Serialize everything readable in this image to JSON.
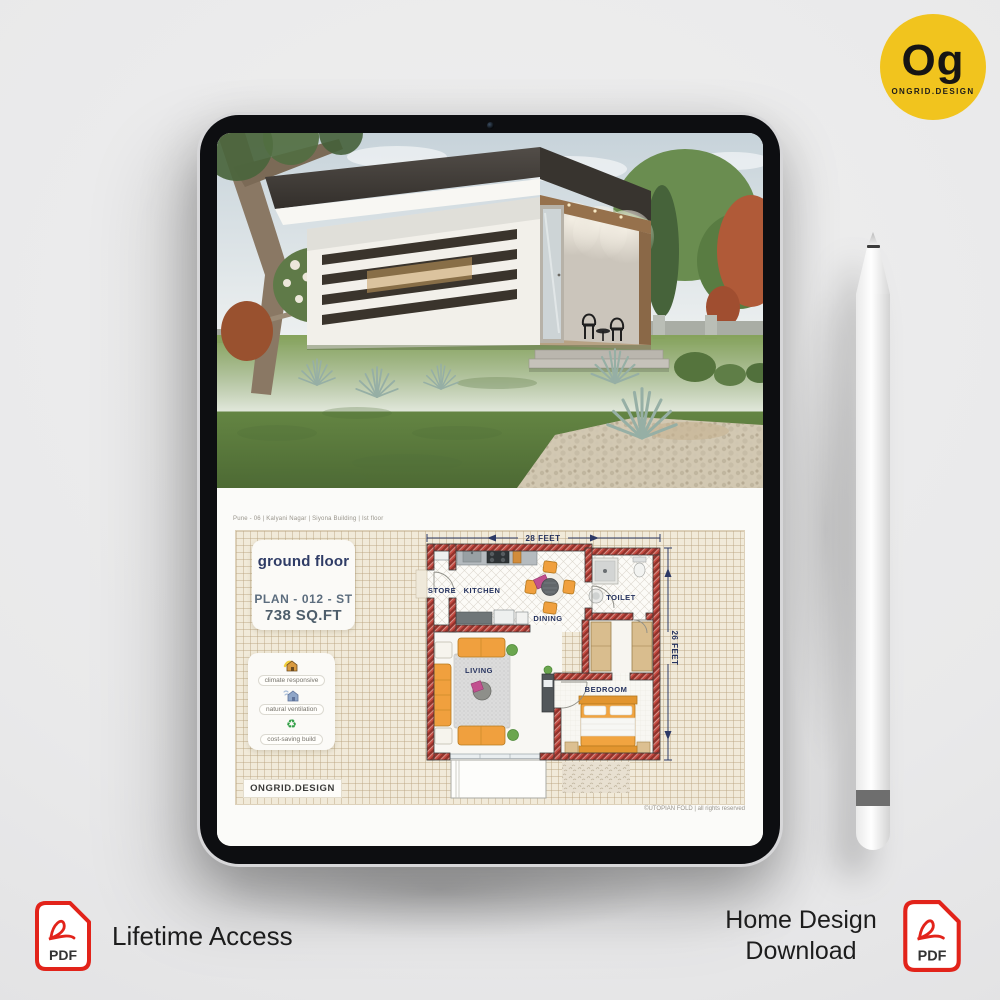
{
  "logo": {
    "monogram": "Og",
    "brand": "ONGRID.DESIGN",
    "bg_color": "#f1c41e"
  },
  "plan_page": {
    "header_note": "Pune - 06 | Kalyani Nagar | Siyona Building | Ist floor",
    "title_card": {
      "title": "ground floor",
      "plan_code": "PLAN - 012 - ST",
      "area": "738 SQ.FT"
    },
    "features": [
      {
        "icon": "climate-house-icon",
        "label": "climate responsive"
      },
      {
        "icon": "ventilation-house-icon",
        "label": "natural ventilation"
      },
      {
        "icon": "recycle-icon",
        "label": "cost-saving build"
      }
    ],
    "brand_badge": "ONGRID.DESIGN",
    "copyright": "©UTOPIAN FOLD | all rights reserved",
    "dimensions": {
      "width": "28 FEET",
      "depth": "26 FEET"
    },
    "rooms": [
      {
        "name": "STORE"
      },
      {
        "name": "KITCHEN"
      },
      {
        "name": "DINING"
      },
      {
        "name": "TOILET"
      },
      {
        "name": "LIVING"
      },
      {
        "name": "BEDROOM"
      }
    ]
  },
  "badges": {
    "left": {
      "icon": "pdf-file-icon",
      "icon_label": "PDF",
      "label": "Lifetime Access"
    },
    "right": {
      "icon": "pdf-file-icon",
      "icon_label": "PDF",
      "label_line1": "Home Design",
      "label_line2": "Download"
    }
  },
  "colors": {
    "accent_red": "#e2231a",
    "logo_yellow": "#f1c41e",
    "wall_red": "#c4483f",
    "label_navy": "#26335f",
    "furniture_orange": "#f0a03e",
    "sheet_beige": "#f1ead9"
  }
}
